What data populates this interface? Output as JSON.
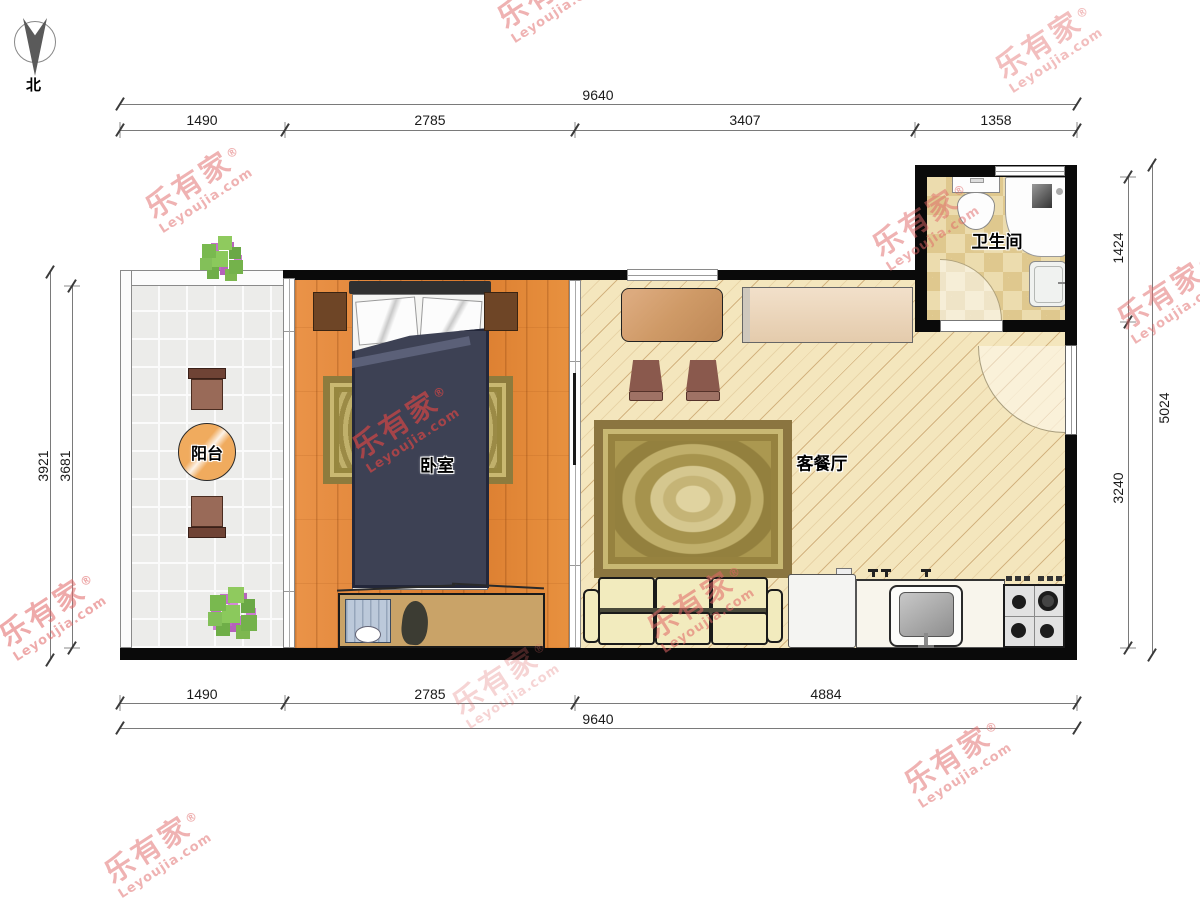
{
  "compass": {
    "label": "北"
  },
  "brand_watermark": {
    "brand": "乐有家",
    "registered": "®",
    "domain": "Leyoujia.com",
    "color": "#e06565"
  },
  "rooms": {
    "bedroom": {
      "label": "卧室"
    },
    "living_dining": {
      "label": "客餐厅"
    },
    "bathroom": {
      "label": "卫生间"
    },
    "balcony": {
      "label": "阳台"
    }
  },
  "dimensions_mm": {
    "top": {
      "total": "9640",
      "segments": [
        "1490",
        "2785",
        "3407",
        "1358"
      ]
    },
    "bottom": {
      "total": "9640",
      "segments": [
        "1490",
        "2785",
        "4884"
      ]
    },
    "left": {
      "outer": "3921",
      "inner": "3681"
    },
    "right": {
      "outer": "5024",
      "segments": [
        "1424",
        "3240"
      ]
    }
  },
  "palette": {
    "wall": "#0a0a0a",
    "wood_floor": "#e1843a",
    "living_floor": "#f4e6bd",
    "bath_tile": "#ecdcae",
    "balcony_tile": "#ececea",
    "rug_gold": "#b19e55",
    "bed_duvet": "#3d4154",
    "sofa_cream": "#f2ebbe",
    "watermark_red": "#e06565",
    "dim_line": "#7a7a7a"
  }
}
